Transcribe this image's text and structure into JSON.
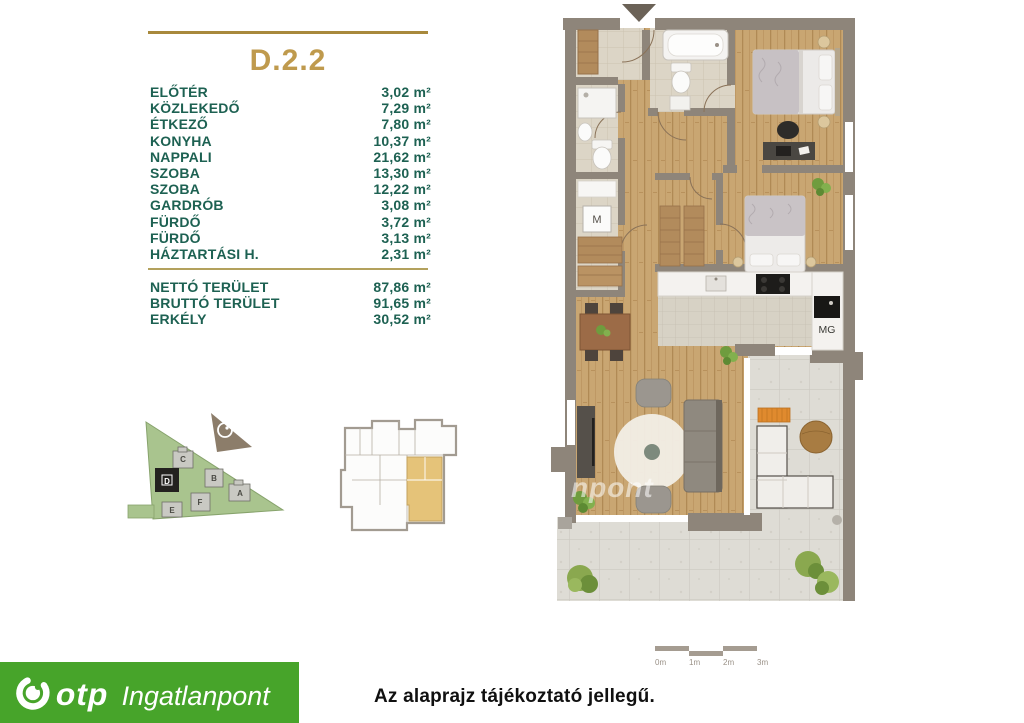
{
  "unit": {
    "title": "D.2.2",
    "rooms": [
      {
        "name": "ELŐTÉR",
        "area": "3,02 m²"
      },
      {
        "name": "KÖZLEKEDŐ",
        "area": "7,29 m²"
      },
      {
        "name": "ÉTKEZŐ",
        "area": "7,80 m²"
      },
      {
        "name": "KONYHA",
        "area": "10,37 m²"
      },
      {
        "name": "NAPPALI",
        "area": "21,62 m²"
      },
      {
        "name": "SZOBA",
        "area": "13,30 m²"
      },
      {
        "name": "SZOBA",
        "area": "12,22 m²"
      },
      {
        "name": "GARDRÓB",
        "area": "3,08 m²"
      },
      {
        "name": "FÜRDŐ",
        "area": "3,72 m²"
      },
      {
        "name": "FÜRDŐ",
        "area": "3,13 m²"
      },
      {
        "name": "HÁZTARTÁSI H.",
        "area": "2,31 m²"
      }
    ],
    "totals": [
      {
        "name": "NETTÓ TERÜLET",
        "area": "87,86 m²"
      },
      {
        "name": "BRUTTÓ TERÜLET",
        "area": "91,65 m²"
      },
      {
        "name": "ERKÉLY",
        "area": "30,52 m²"
      }
    ]
  },
  "floorplan": {
    "appliance_washer": "M",
    "appliance_dishwasher": "MG",
    "scale_ticks": [
      "0m",
      "1m",
      "2m",
      "3m"
    ],
    "watermark": "npont"
  },
  "site_plan": {
    "buildings": [
      "A",
      "B",
      "C",
      "D",
      "E",
      "F"
    ],
    "highlighted_building": "D"
  },
  "footer": {
    "brand": "otp",
    "brand_suffix": "Ingatlanpont",
    "disclaimer": "Az alaprajz tájékoztató jellegű."
  },
  "colors": {
    "accent_gold": "#b7944a",
    "text_green": "#1d6152",
    "brand_green": "#47a42a",
    "highlight_tan": "#e5c379"
  }
}
